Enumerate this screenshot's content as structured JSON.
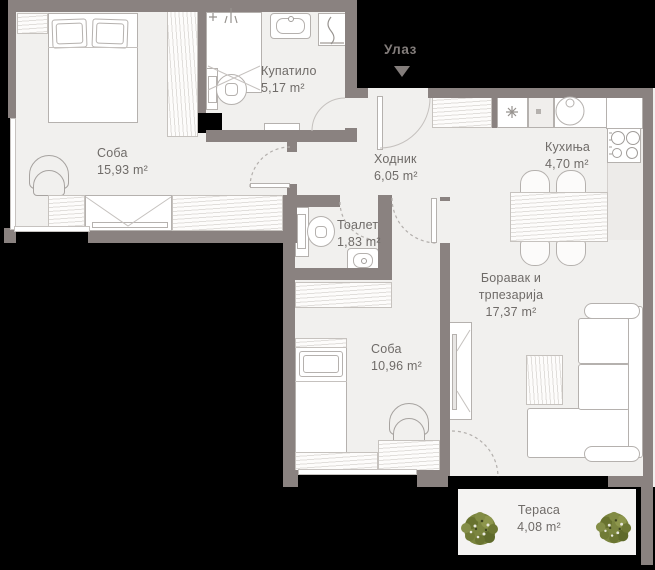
{
  "entrance": {
    "label": "Улаз"
  },
  "rooms": {
    "bedroom1": {
      "name": "Соба",
      "area": "15,93 m²"
    },
    "bathroom": {
      "name": "Купатило",
      "area": "5,17 m²"
    },
    "hallway": {
      "name": "Ходник",
      "area": "6,05 m²"
    },
    "kitchen": {
      "name": "Кухиња",
      "area": "4,70 m²"
    },
    "toilet": {
      "name": "Тоалет",
      "area": "1,83 m²"
    },
    "living": {
      "lines": [
        "Боравак и",
        "трпезарија"
      ],
      "area": "17,37 m²"
    },
    "bedroom2": {
      "name": "Соба",
      "area": "10,96 m²"
    },
    "terrace": {
      "name": "Тераса",
      "area": "4,08 m²"
    }
  },
  "colors": {
    "wall": "#8a8280",
    "floor": "#f1f0ee",
    "outside": "#000000",
    "label": "#6f6b68",
    "entrance": "#837d7b",
    "stroke": "#b5b1ae",
    "plant": "#7b853f"
  }
}
